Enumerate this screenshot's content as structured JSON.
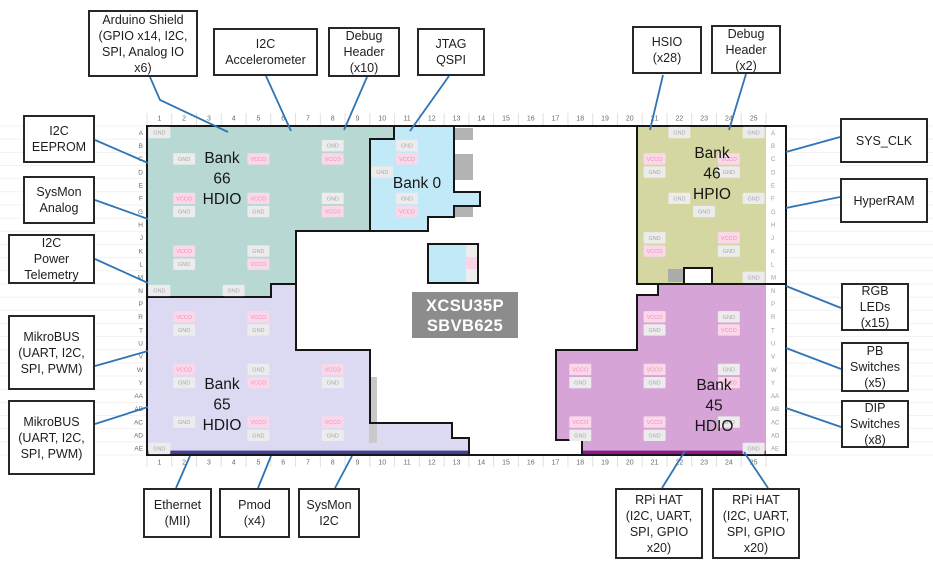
{
  "callouts": {
    "arduino": {
      "label": "Arduino Shield\n(GPIO x14, I2C,\nSPI, Analog IO\nx6)"
    },
    "accelerometer": {
      "label": "I2C\nAccelerometer"
    },
    "debug_header_10": {
      "label": "Debug\nHeader\n(x10)"
    },
    "jtag": {
      "label": "JTAG\nQSPI"
    },
    "hsio": {
      "label": "HSIO\n(x28)"
    },
    "debug_header_2": {
      "label": "Debug\nHeader\n(x2)"
    },
    "eeprom": {
      "label": "I2C\nEEPROM"
    },
    "sysmon_analog": {
      "label": "SysMon\nAnalog"
    },
    "telemetry": {
      "label": "I2C\nPower\nTelemetry"
    },
    "mikrobus1": {
      "label": "MikroBUS\n(UART, I2C,\nSPI, PWM)"
    },
    "mikrobus2": {
      "label": "MikroBUS\n(UART, I2C,\nSPI, PWM)"
    },
    "sys_clk": {
      "label": "SYS_CLK"
    },
    "hyperram": {
      "label": "HyperRAM"
    },
    "rgb_leds": {
      "label": "RGB\nLEDs\n(x15)"
    },
    "pb_switches": {
      "label": "PB\nSwitches\n(x5)"
    },
    "dip_switches": {
      "label": "DIP\nSwitches\n(x8)"
    },
    "ethernet": {
      "label": "Ethernet\n(MII)"
    },
    "pmod": {
      "label": "Pmod\n(x4)"
    },
    "sysmon_i2c": {
      "label": "SysMon\nI2C"
    },
    "rpi_hat1": {
      "label": "RPi HAT\n(I2C, UART,\nSPI, GPIO\nx20)"
    },
    "rpi_hat2": {
      "label": "RPi HAT\n(I2C, UART,\nSPI, GPIO\nx20)"
    }
  },
  "diagram": {
    "part": {
      "lines": [
        "XCSU35P",
        "SBVB625"
      ],
      "bg": "#8c8c8c",
      "fg": "#ffffff",
      "x": 412,
      "y": 292,
      "w": 106,
      "h": 46
    },
    "grid": {
      "x0": 147,
      "y0": 126,
      "cols": 25,
      "rows": 25,
      "cw": 24.76,
      "rh": 13.16,
      "label_color": "#6a6a6a",
      "col_labels": [
        "1",
        "2",
        "3",
        "4",
        "5",
        "6",
        "7",
        "8",
        "9",
        "10",
        "11",
        "12",
        "13",
        "14",
        "15",
        "16",
        "17",
        "18",
        "19",
        "20",
        "21",
        "22",
        "23",
        "24",
        "25"
      ],
      "row_labels": [
        "A",
        "B",
        "C",
        "D",
        "E",
        "F",
        "G",
        "H",
        "J",
        "K",
        "L",
        "M",
        "N",
        "P",
        "R",
        "T",
        "U",
        "V",
        "W",
        "Y",
        "AA",
        "AB",
        "AC",
        "AD",
        "AE"
      ]
    },
    "package": {
      "x": 147,
      "y": 126,
      "w": 639,
      "h": 329,
      "stroke": "#161616"
    },
    "ball_colors": {
      "GND": {
        "bg": "#ececec",
        "fg": "#a9a9a9"
      },
      "VCCO": {
        "bg": "#fbd8e9",
        "fg": "#ee8cb9"
      }
    },
    "banks": [
      {
        "id": "bank-66",
        "title": "Bank\n66\nHDIO",
        "fill": "#b8d9d3",
        "lx": 222,
        "ly": 163,
        "path": "M147,126 L394,126 L394,139 L370,139 L370,231 L296,231 L296,284 L271,284 L271,297 L147,297 Z",
        "balls": [
          [
            1,
            1,
            "GND"
          ],
          [
            8,
            2,
            "GND"
          ],
          [
            2,
            3,
            "GND"
          ],
          [
            5,
            3,
            "VCCO"
          ],
          [
            8,
            3,
            "VCCO"
          ],
          [
            2,
            6,
            "VCCO"
          ],
          [
            5,
            6,
            "VCCO"
          ],
          [
            8,
            6,
            "GND"
          ],
          [
            2,
            7,
            "GND"
          ],
          [
            5,
            7,
            "GND"
          ],
          [
            8,
            7,
            "VCCO"
          ],
          [
            2,
            10,
            "VCCO"
          ],
          [
            5,
            10,
            "GND"
          ],
          [
            2,
            11,
            "GND"
          ],
          [
            5,
            11,
            "VCCO"
          ],
          [
            1,
            13,
            "GND"
          ],
          [
            4,
            13,
            "GND"
          ]
        ]
      },
      {
        "id": "bank-0",
        "title": "Bank 0",
        "fill": "#c2e9f8",
        "lx": 417,
        "ly": 188,
        "path": "M394,126 L454,126 L454,192 L480,192 L480,206 L454,206 L454,217 L428,217 L428,231 L370,231 L370,139 L394,139 Z",
        "balls": [
          [
            11,
            2,
            "GND"
          ],
          [
            11,
            3,
            "VCCO"
          ],
          [
            10,
            4,
            "GND"
          ],
          [
            11,
            6,
            "GND"
          ],
          [
            11,
            7,
            "VCCO"
          ]
        ]
      },
      {
        "id": "bank-0-island",
        "title": "",
        "fill": "#c2e9f8",
        "lx": 0,
        "ly": 0,
        "path": "M428,244 L478,244 L478,283 L428,283 Z",
        "balls": []
      },
      {
        "id": "bank-46",
        "title": "Bank\n46\nHPIO",
        "fill": "#d4d7a2",
        "lx": 712,
        "ly": 158,
        "path": "M637,126 L786,126 L786,284 L712,284 L712,268 L684,268 L684,284 L637,284 Z",
        "balls": [
          [
            22,
            1,
            "GND"
          ],
          [
            25,
            1,
            "GND"
          ],
          [
            21,
            3,
            "VCCO"
          ],
          [
            24,
            3,
            "VCCO"
          ],
          [
            21,
            4,
            "GND"
          ],
          [
            24,
            4,
            "GND"
          ],
          [
            22,
            6,
            "GND"
          ],
          [
            25,
            6,
            "GND"
          ],
          [
            23,
            7,
            "GND"
          ],
          [
            21,
            9,
            "GND"
          ],
          [
            24,
            9,
            "VCCO"
          ],
          [
            21,
            10,
            "VCCO"
          ],
          [
            24,
            10,
            "GND"
          ],
          [
            25,
            12,
            "GND"
          ]
        ]
      },
      {
        "id": "bank-65",
        "title": "Bank\n65\nHDIO",
        "fill": "#dcd9f3",
        "lx": 222,
        "ly": 389,
        "path": "M147,297 L271,297 L271,284 L296,284 L296,350 L370,350 L370,423 L452,423 L452,438 L469,438 L469,455 L147,455 Z",
        "balls": [
          [
            2,
            15,
            "VCCO"
          ],
          [
            5,
            15,
            "VCCO"
          ],
          [
            2,
            16,
            "GND"
          ],
          [
            5,
            16,
            "GND"
          ],
          [
            2,
            19,
            "VCCO"
          ],
          [
            5,
            19,
            "GND"
          ],
          [
            8,
            19,
            "VCCO"
          ],
          [
            2,
            20,
            "GND"
          ],
          [
            5,
            20,
            "VCCO"
          ],
          [
            8,
            20,
            "GND"
          ],
          [
            2,
            23,
            "GND"
          ],
          [
            5,
            23,
            "VCCO"
          ],
          [
            8,
            23,
            "VCCO"
          ],
          [
            5,
            24,
            "GND"
          ],
          [
            8,
            24,
            "GND"
          ],
          [
            1,
            25,
            "GND"
          ]
        ]
      },
      {
        "id": "bank-45",
        "title": "Bank\n45\nHDIO",
        "fill": "#d7a4d8",
        "lx": 714,
        "ly": 390,
        "path": "M658,284 L786,284 L786,455 L582,455 L582,440 L556,440 L556,350 L637,350 L637,295 L658,295 Z",
        "balls": [
          [
            21,
            15,
            "VCCO"
          ],
          [
            24,
            15,
            "GND"
          ],
          [
            21,
            16,
            "GND"
          ],
          [
            24,
            16,
            "VCCO"
          ],
          [
            18,
            19,
            "VCCO"
          ],
          [
            21,
            19,
            "VCCO"
          ],
          [
            24,
            19,
            "GND"
          ],
          [
            18,
            20,
            "GND"
          ],
          [
            21,
            20,
            "GND"
          ],
          [
            24,
            20,
            "VCCO"
          ],
          [
            18,
            23,
            "VCCO"
          ],
          [
            21,
            23,
            "VCCO"
          ],
          [
            24,
            23,
            "GND"
          ],
          [
            18,
            24,
            "GND"
          ],
          [
            21,
            24,
            "GND"
          ],
          [
            25,
            25,
            "GND"
          ]
        ]
      }
    ],
    "accents": [
      {
        "x": 455,
        "y": 128,
        "w": 18,
        "h": 12,
        "fill": "#b3b3b3"
      },
      {
        "x": 455,
        "y": 154,
        "w": 18,
        "h": 26,
        "fill": "#b3b3b3"
      },
      {
        "x": 455,
        "y": 206,
        "w": 18,
        "h": 11,
        "fill": "#b3b3b3"
      },
      {
        "x": 466,
        "y": 245,
        "w": 11,
        "h": 37,
        "fill": "#ededed"
      },
      {
        "x": 466,
        "y": 257,
        "w": 11,
        "h": 12,
        "fill": "#f9d3e6"
      },
      {
        "x": 369,
        "y": 377,
        "w": 8,
        "h": 66,
        "fill": "#c9c9c9"
      },
      {
        "x": 668,
        "y": 269,
        "w": 15,
        "h": 13,
        "fill": "#ababab"
      },
      {
        "x": 766,
        "y": 127,
        "w": 19,
        "h": 327,
        "fill": "#ffffff"
      }
    ],
    "strips": [
      {
        "x": 147,
        "y": 450.6,
        "w": 322,
        "h": 4,
        "fill": "#453f91"
      },
      {
        "x": 582,
        "y": 450.6,
        "w": 184,
        "h": 4,
        "fill": "#8f188f"
      }
    ],
    "leader": {
      "color": "#2e74b5",
      "width": 1.8,
      "lines": [
        [
          [
            150,
            77
          ],
          [
            160,
            100
          ],
          [
            228,
            132
          ]
        ],
        [
          [
            266,
            76
          ],
          [
            291,
            131
          ]
        ],
        [
          [
            367,
            77
          ],
          [
            344,
            130
          ]
        ],
        [
          [
            449,
            76
          ],
          [
            410,
            131
          ]
        ],
        [
          [
            663,
            75
          ],
          [
            650,
            130
          ]
        ],
        [
          [
            746,
            74
          ],
          [
            729,
            130
          ]
        ],
        [
          [
            95,
            140
          ],
          [
            148,
            163
          ]
        ],
        [
          [
            95,
            200
          ],
          [
            148,
            219
          ]
        ],
        [
          [
            95,
            259
          ],
          [
            148,
            283
          ]
        ],
        [
          [
            95,
            366
          ],
          [
            148,
            351
          ]
        ],
        [
          [
            95,
            424
          ],
          [
            148,
            407
          ]
        ],
        [
          [
            786,
            152
          ],
          [
            840,
            137
          ]
        ],
        [
          [
            786,
            208
          ],
          [
            840,
            197
          ]
        ],
        [
          [
            786,
            286
          ],
          [
            841,
            308
          ]
        ],
        [
          [
            786,
            348
          ],
          [
            841,
            369
          ]
        ],
        [
          [
            786,
            408
          ],
          [
            841,
            427
          ]
        ],
        [
          [
            190,
            456
          ],
          [
            176,
            488
          ]
        ],
        [
          [
            271,
            456
          ],
          [
            258,
            488
          ]
        ],
        [
          [
            352,
            456
          ],
          [
            335,
            488
          ]
        ],
        [
          [
            685,
            451
          ],
          [
            662,
            488
          ]
        ],
        [
          [
            744,
            452
          ],
          [
            768,
            488
          ]
        ]
      ]
    }
  }
}
